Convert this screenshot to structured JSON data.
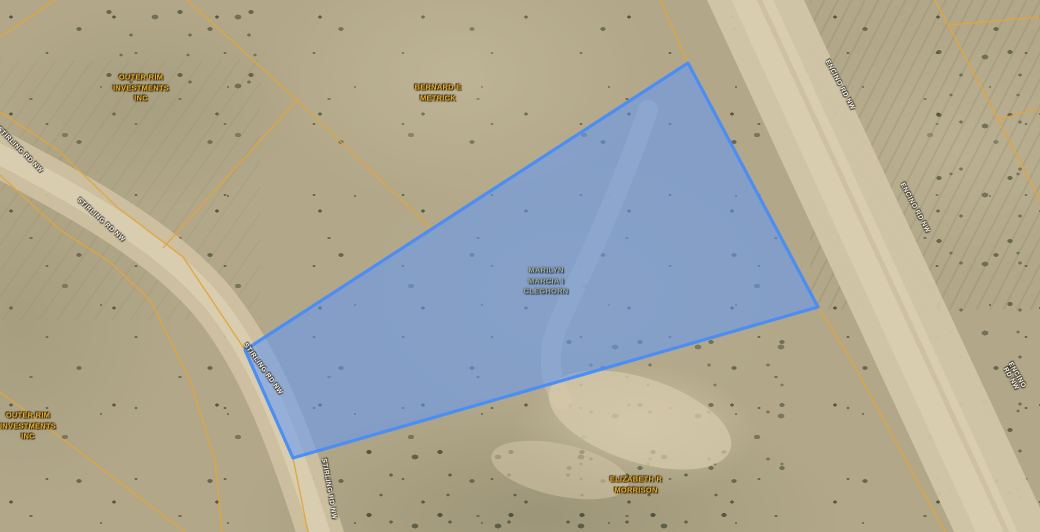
{
  "map": {
    "type": "parcel-map-aerial",
    "colors": {
      "parcel_line": "#e2a53e",
      "selected_parcel_fill": "rgba(94,152,250,0.55)",
      "selected_parcel_border": "rgba(72,140,248,0.95)",
      "owner_label": "#eeb02b",
      "road_label": "#f6f3ea"
    },
    "selected_parcel": {
      "owner": "MARILYN\nMARCIA I\nCLEGHORN"
    },
    "owner_labels": [
      {
        "id": "outer-rim-north",
        "text": "OUTER RIM\nINVESTMENTS\nINC"
      },
      {
        "id": "bernard-metrick",
        "text": "BERNARD E\nMETRICK"
      },
      {
        "id": "marilyn-cleghorn",
        "text": "MARILYN\nMARCIA I\nCLEGHORN"
      },
      {
        "id": "outer-rim-south",
        "text": "OUTER RIM\nINVESTMENTS\nINC"
      },
      {
        "id": "elizabeth-morrison",
        "text": "ELIZABETH R\nMORRISON"
      }
    ],
    "road_labels": [
      {
        "id": "stirling-upper",
        "text": "STIRLING RD NW"
      },
      {
        "id": "stirling-mid",
        "text": "STIRLING RD NW"
      },
      {
        "id": "stirling-parcel",
        "text": "STIRLING RD NW"
      },
      {
        "id": "stirling-lower",
        "text": "STIRLING RD NW"
      },
      {
        "id": "encino-top",
        "text": "ENCINO RD NW"
      },
      {
        "id": "encino-mid",
        "text": "ENCINO RD NW"
      },
      {
        "id": "encino-lower",
        "text": "ENCINO RD NW"
      }
    ]
  }
}
